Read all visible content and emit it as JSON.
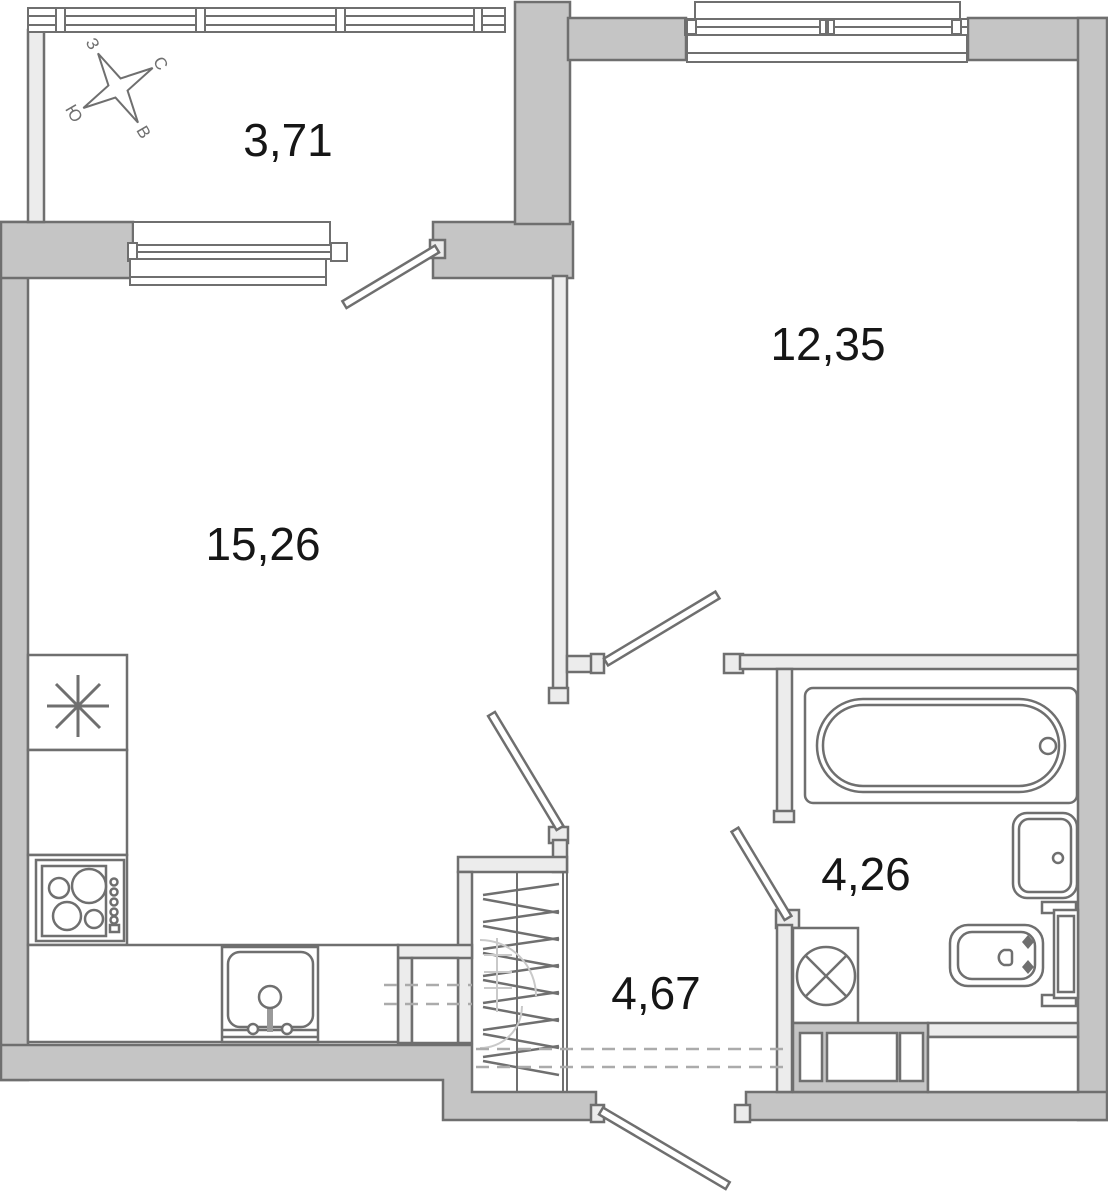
{
  "document": {
    "type": "apartment-floor-plan"
  },
  "rooms": {
    "balcony": {
      "area": "3,71"
    },
    "bedroom": {
      "area": "12,35"
    },
    "living_kitchen": {
      "area": "15,26"
    },
    "bathroom": {
      "area": "4,26"
    },
    "hallway": {
      "area": "4,67"
    }
  },
  "compass": {
    "north": "С",
    "east": "В",
    "south": "Ю",
    "west": "З"
  },
  "colors": {
    "wall_fill": "#c5c5c5",
    "partition_fill": "#ececec",
    "outline": "#6f6f6f",
    "label_text": "#161616",
    "dashed_line": "#ababab",
    "background": "#ffffff"
  }
}
